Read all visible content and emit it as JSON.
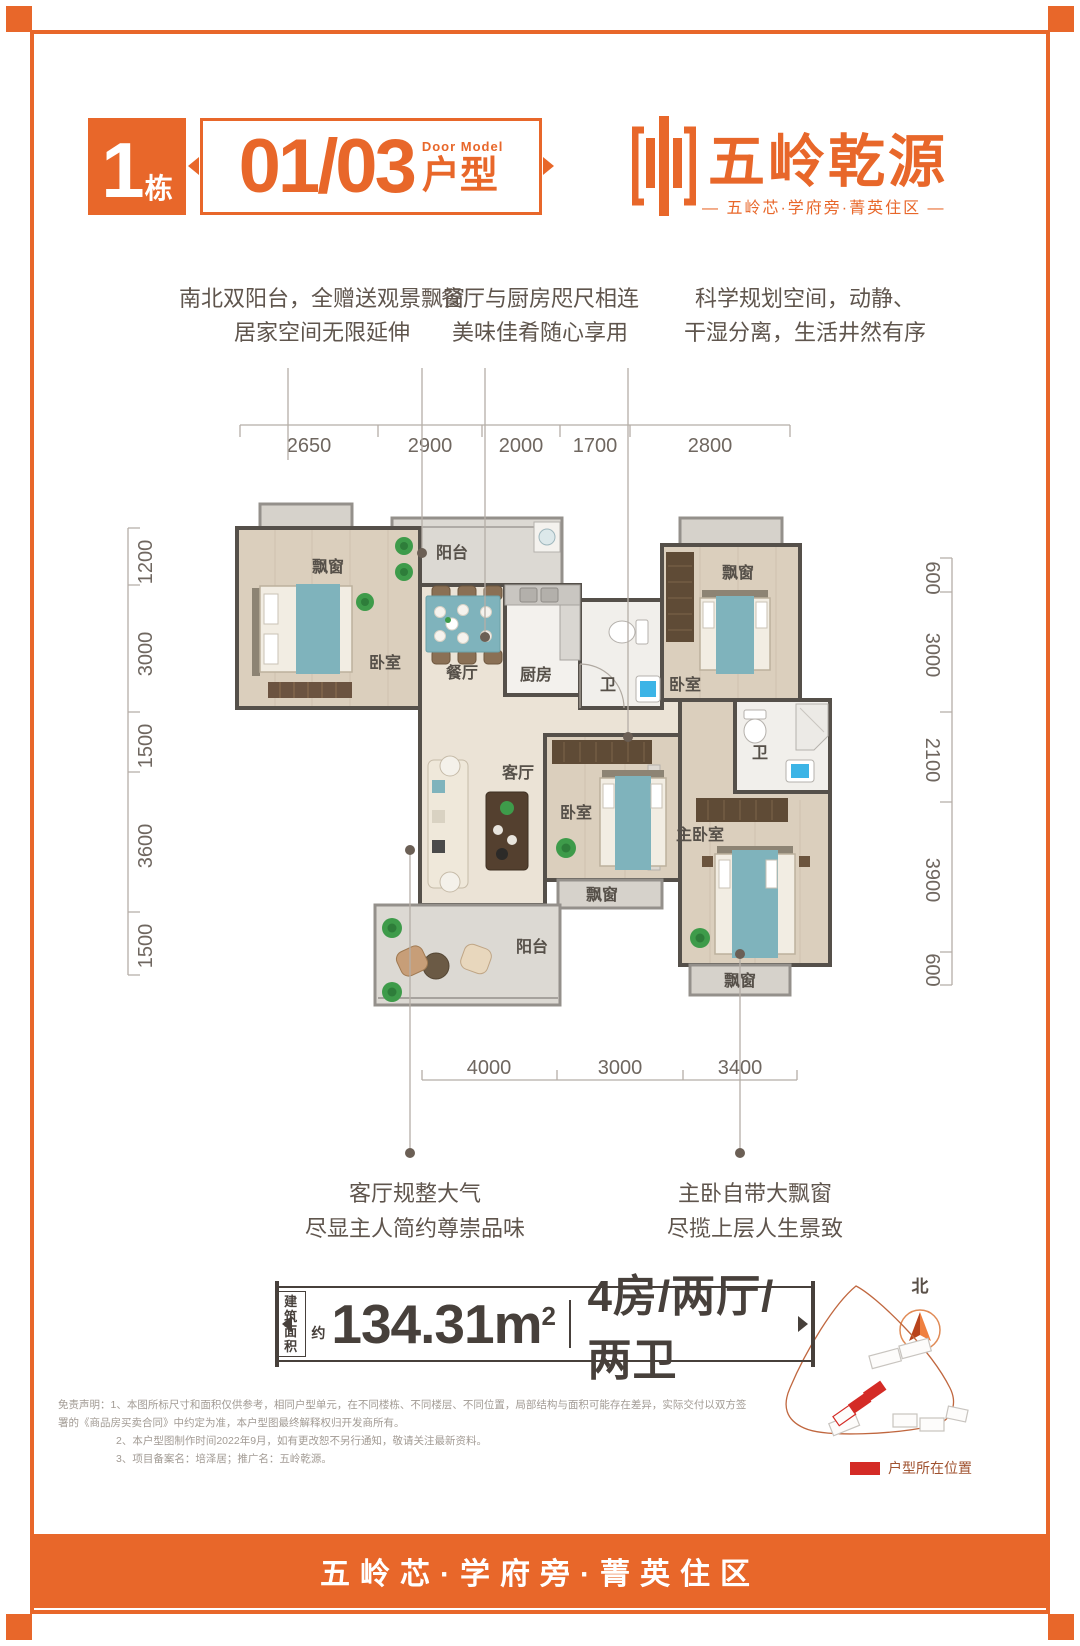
{
  "brand": {
    "accent_color": "#E8672A",
    "building_number": "1",
    "building_unit_label": "栋",
    "unit_numbers": "01/03",
    "door_model_en": "Door Model",
    "door_model_cn": "户型",
    "logo_name": "五岭乾源",
    "logo_tagline": "— 五岭芯·学府旁·菁英住区 —"
  },
  "features_top": [
    {
      "line1": "南北双阳台，全赠送观景飘窗",
      "line2": "居家空间无限延伸"
    },
    {
      "line1": "餐厅与厨房咫尺相连",
      "line2": "美味佳肴随心享用"
    },
    {
      "line1": "科学规划空间，动静、",
      "line2": "干湿分离，生活井然有序"
    }
  ],
  "features_bottom": [
    {
      "line1": "客厅规整大气",
      "line2": "尽显主人简约尊崇品味"
    },
    {
      "line1": "主卧自带大飘窗",
      "line2": "尽揽上层人生景致"
    }
  ],
  "floor_plan": {
    "dims_top": [
      "2650",
      "2900",
      "2000",
      "1700",
      "2800"
    ],
    "dims_left": [
      "1200",
      "3000",
      "1500",
      "3600",
      "1500"
    ],
    "dims_right": [
      "600",
      "3000",
      "2100",
      "3900",
      "600"
    ],
    "dims_bottom": [
      "4000",
      "3000",
      "3400"
    ],
    "rooms": {
      "bay_window": "飘窗",
      "balcony": "阳台",
      "bedroom": "卧室",
      "dining": "餐厅",
      "kitchen": "厨房",
      "bath": "卫",
      "living": "客厅",
      "master_bedroom": "主卧室"
    }
  },
  "area_bar": {
    "label_line1": "建筑",
    "label_line2": "面积",
    "approx": "约",
    "area_value": "134.31m",
    "area_sup": "2",
    "layout": "4房/两厅/两卫"
  },
  "site_map": {
    "north_label": "北",
    "legend_label": "户型所在位置",
    "highlight_color": "#d42b26"
  },
  "disclaimer": {
    "line1": "免责声明：1、本图所标尺寸和面积仅供参考，相同户型单元，在不同楼栋、不同楼层、不同位置，局部结构与面积可能存在差异，实际交付以双方签署的《商品房买卖合同》中约定为准，本户型图最终解释权归开发商所有。",
    "line2": "2、本户型图制作时间2022年9月，如有更改恕不另行通知，敬请关注最新资料。",
    "line3": "3、项目备案名：培泽居；推广名：五岭乾源。"
  },
  "footer": {
    "slogan": "五岭芯·学府旁·菁英住区"
  }
}
